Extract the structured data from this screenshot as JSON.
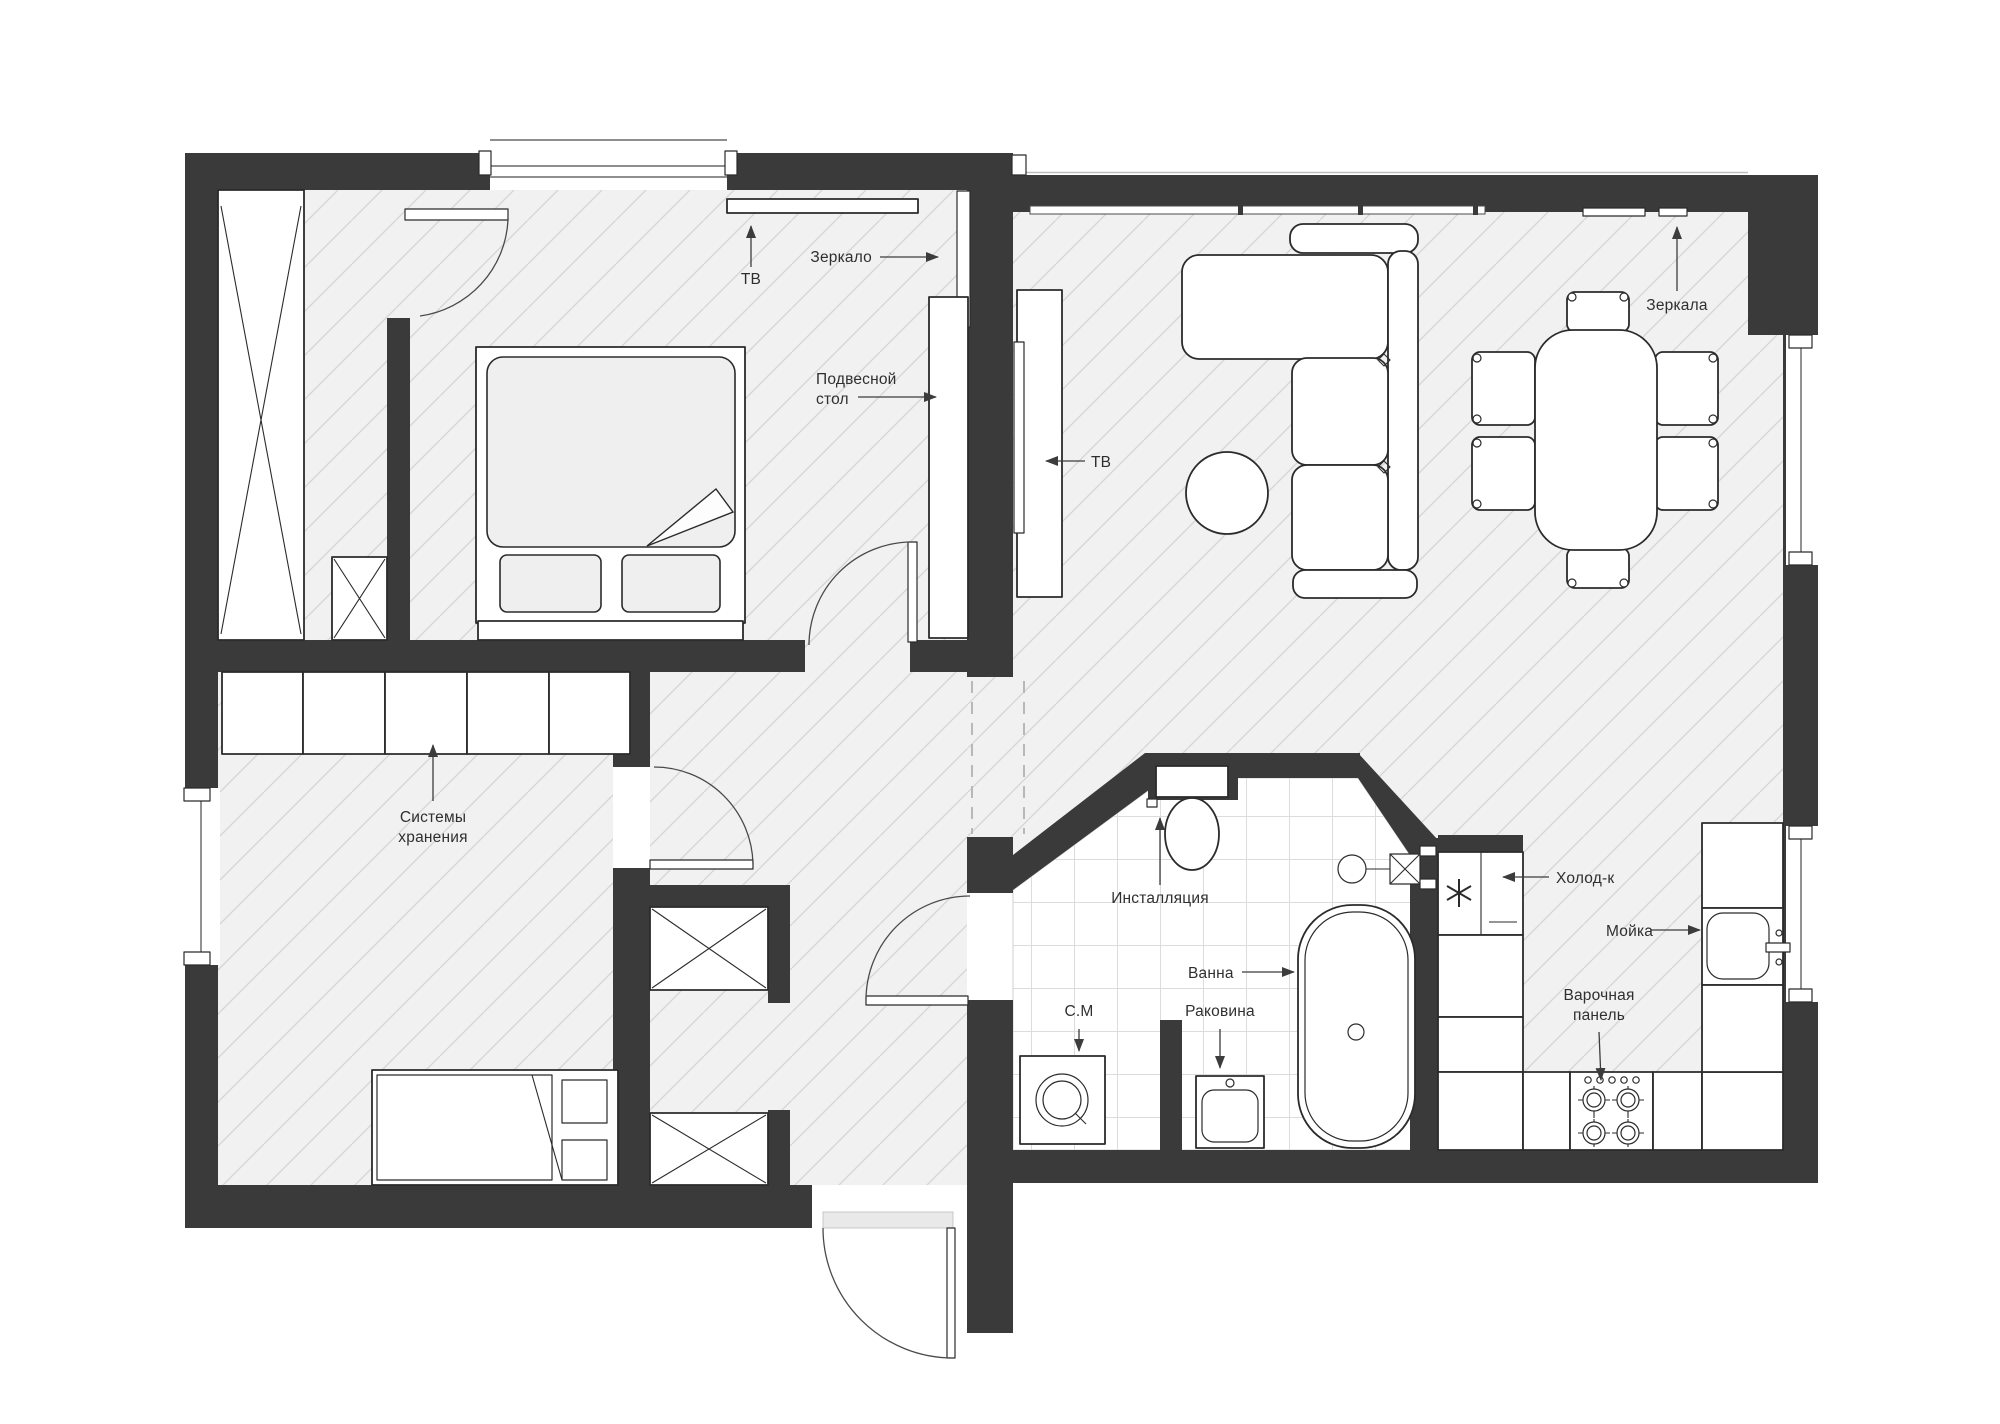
{
  "title": "Apartment floor plan",
  "colors": {
    "wall": "#3a3a3a",
    "line": "#2b2b2b",
    "floor": "#f1f1f1",
    "hatch": "#d5d5d5",
    "tile": "#dcdcdc",
    "label": "#2f2f2f",
    "arrow": "#3c3c3c",
    "soft": "#efefef",
    "threshold": "#e9e9e9"
  },
  "labels": {
    "bedroom_tv": "ТВ",
    "bedroom_mirror": "Зеркало",
    "bedroom_desk_line1": "Подвесной",
    "bedroom_desk_line2": "стол",
    "living_tv": "ТВ",
    "living_mirrors": "Зеркала",
    "kids_storage_line1": "Системы",
    "kids_storage_line2": "хранения",
    "bath_installation": "Инсталляция",
    "bath_tub": "Ванна",
    "bath_washer": "С.М",
    "bath_sink": "Раковина",
    "kitchen_fridge": "Холод-к",
    "kitchen_sink": "Мойка",
    "kitchen_cooktop_line1": "Варочная",
    "kitchen_cooktop_line2": "панель"
  }
}
